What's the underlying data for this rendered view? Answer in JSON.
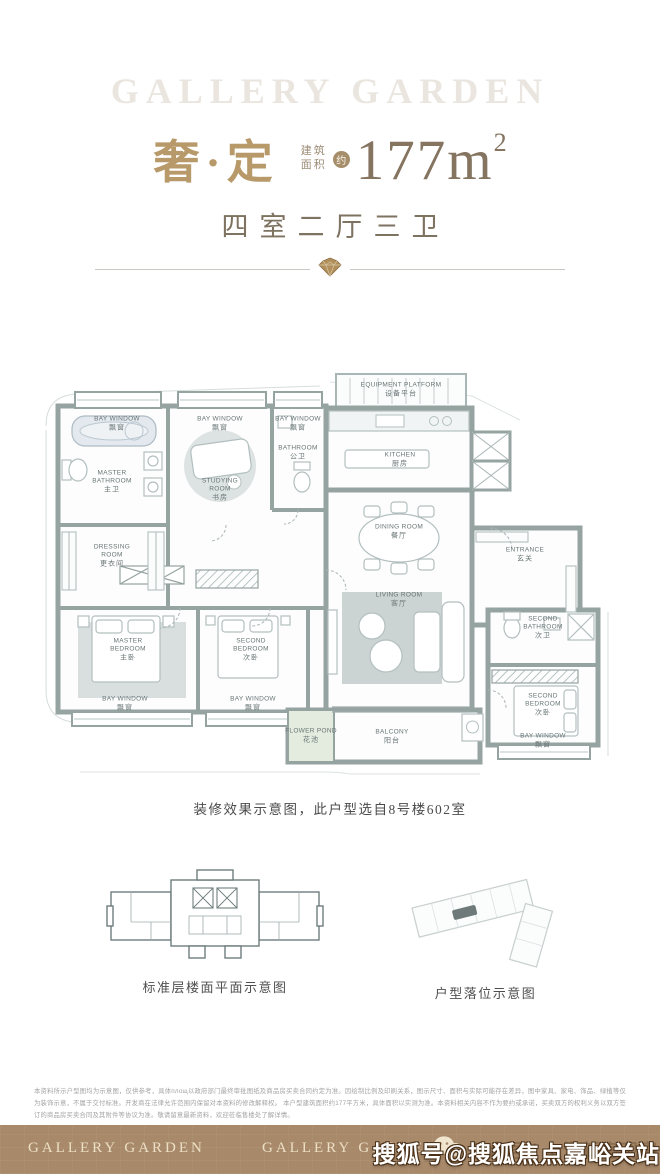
{
  "header": {
    "watermark": "GALLERY GARDEN",
    "title": "奢·定",
    "area_label_line1": "建筑",
    "area_label_line2": "面积",
    "area_badge": "约",
    "area_value": "177m",
    "area_sup": "2",
    "subtitle": "四室二厅三卫"
  },
  "colors": {
    "gold": "#b7996a",
    "taupe": "#847460",
    "wall_gray": "#95a3a1",
    "footer_bar": "#a8896a"
  },
  "floorplan": {
    "rooms": [
      {
        "id": "bay-window-top-1",
        "en": "BAY WINDOW",
        "zh": "飘窗"
      },
      {
        "id": "bay-window-top-2",
        "en": "BAY WINDOW",
        "zh": "飘窗"
      },
      {
        "id": "bay-window-top-3",
        "en": "BAY WINDOW",
        "zh": "飘窗"
      },
      {
        "id": "master-bathroom",
        "en": "MASTER BATHROOM",
        "zh": "主卫"
      },
      {
        "id": "studying-room",
        "en": "STUDYING ROOM",
        "zh": "书房"
      },
      {
        "id": "bathroom",
        "en": "BATHROOM",
        "zh": "公卫"
      },
      {
        "id": "equipment-platform",
        "en": "EQUIPMENT PLATFORM",
        "zh": "设备平台"
      },
      {
        "id": "kitchen",
        "en": "KITCHEN",
        "zh": "厨房"
      },
      {
        "id": "dining-room",
        "en": "DINING ROOM",
        "zh": "餐厅"
      },
      {
        "id": "entrance",
        "en": "ENTRANCE",
        "zh": "玄关"
      },
      {
        "id": "dressing-room",
        "en": "DRESSING ROOM",
        "zh": "更衣间"
      },
      {
        "id": "master-bedroom",
        "en": "MASTER BEDROOM",
        "zh": "主卧"
      },
      {
        "id": "second-bedroom-left",
        "en": "SECOND BEDROOM",
        "zh": "次卧"
      },
      {
        "id": "living-room",
        "en": "LIVING ROOM",
        "zh": "客厅"
      },
      {
        "id": "second-bathroom",
        "en": "SECOND BATHROOM",
        "zh": "次卫"
      },
      {
        "id": "second-bedroom-right",
        "en": "SECOND BEDROOM",
        "zh": "次卧"
      },
      {
        "id": "bay-window-bottom-1",
        "en": "BAY WINDOW",
        "zh": "飘窗"
      },
      {
        "id": "bay-window-bottom-2",
        "en": "BAY WINDOW",
        "zh": "飘窗"
      },
      {
        "id": "bay-window-bottom-right",
        "en": "BAY WINDOW",
        "zh": "飘窗"
      },
      {
        "id": "flower-pond",
        "en": "FLOWER POND",
        "zh": "花池"
      },
      {
        "id": "balcony",
        "en": "BALCONY",
        "zh": "阳台"
      }
    ]
  },
  "caption": {
    "text": "装修效果示意图，此户型选自8号楼602室"
  },
  "mini_diagrams": {
    "left_caption": "标准层楼面平面示意图",
    "right_caption": "户型落位示意图"
  },
  "disclaimer": {
    "line1": "本资料所示户型图均为示意图，仅供参考，具体площ以政府部门最终审批图纸及商品房买卖合同约定为准。因绘制比例及印刷关系，图示尺寸、面积与实际可能存在差异，图中家具、家电、饰品、绿植等仅为装饰示意，不属于交付标准。开发商在法律允许范围内保留对本资料的修改解释权。",
    "line2": "本户型建筑面积约177平方米，具体面积以实测为准。本资料相关内容不作为要约或承诺，买卖双方的权利义务以双方签订的商品房买卖合同及其附件等协议为准。敬请留意最新资料，欢迎莅临售楼处了解详情。"
  },
  "footer": {
    "logo_left": "GALLERY GARDEN",
    "logo_center": "GALLERY GARDEN",
    "account_text": "公众号 | 上海新房观察",
    "watermark": "搜狐号@搜狐焦点嘉峪关站"
  }
}
